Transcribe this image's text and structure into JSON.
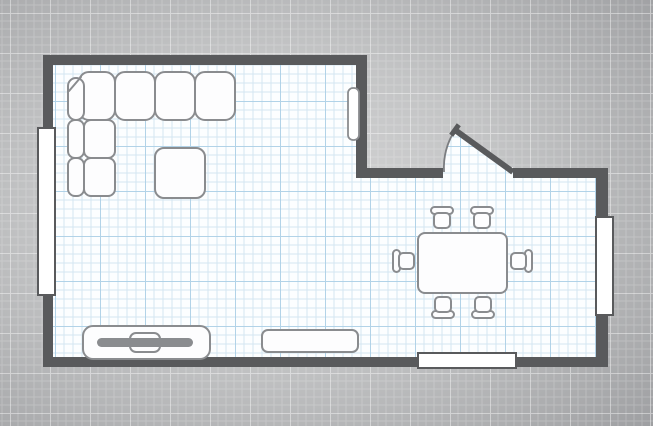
{
  "title": "floor-plan-canvas",
  "canvas": {
    "width": 653,
    "height": 426
  },
  "colors": {
    "wall": "#595a5c",
    "exterior_center": "#d5d5d6",
    "exterior_mid": "#c3c4c5",
    "exterior_edge": "#9c9da0",
    "exterior_grid": "#ffffff",
    "floor": "#fcfeff",
    "floor_grid": "#cde2f0",
    "floor_grid_accent": "#aacfe6",
    "furniture_fill": "#fdfdfe",
    "furniture_stroke": "#8a8c8f",
    "tv_screen_fill": "#8a8c8f",
    "window_fill": "#ffffff",
    "window_stroke": "#595a5c",
    "door_arc_stroke": "#7b7d80"
  },
  "grids": {
    "floor": {
      "cell": 9,
      "accent_every": 5,
      "offset": [
        10,
        11
      ]
    },
    "exterior": {
      "cell": 8,
      "accent_every": 5,
      "offset": [
        10,
        13
      ]
    }
  },
  "floor_polygon": [
    [
      53,
      65
    ],
    [
      356,
      65
    ],
    [
      356,
      178
    ],
    [
      596,
      178
    ],
    [
      596,
      357
    ],
    [
      53,
      357
    ]
  ],
  "walls": [
    {
      "name": "wall-top",
      "x": 43,
      "y": 55,
      "w": 324,
      "h": 10
    },
    {
      "name": "wall-left",
      "x": 43,
      "y": 55,
      "w": 10,
      "h": 312
    },
    {
      "name": "wall-bottom",
      "x": 43,
      "y": 357,
      "w": 565,
      "h": 10
    },
    {
      "name": "wall-inner-vertical",
      "x": 356,
      "y": 55,
      "w": 11,
      "h": 123
    },
    {
      "name": "wall-hall-left",
      "x": 356,
      "y": 168,
      "w": 87,
      "h": 10
    },
    {
      "name": "wall-hall-right",
      "x": 513,
      "y": 168,
      "w": 95,
      "h": 10
    },
    {
      "name": "wall-right",
      "x": 596,
      "y": 168,
      "w": 12,
      "h": 199
    }
  ],
  "windows": [
    {
      "name": "window-left",
      "x": 38,
      "y": 128,
      "w": 17,
      "h": 167
    },
    {
      "name": "window-right",
      "x": 596,
      "y": 217,
      "w": 17,
      "h": 98
    },
    {
      "name": "window-bottom",
      "x": 418,
      "y": 353,
      "w": 98,
      "h": 15
    }
  ],
  "door": {
    "name": "entry-door",
    "opening": {
      "x": 443,
      "y": 168,
      "w": 70,
      "h": 10
    },
    "hinge": [
      513,
      172
    ],
    "arc_start": [
      444,
      172
    ],
    "tip": [
      455,
      130
    ],
    "radius": 71,
    "leaf_width": 6,
    "cap_half_length": 6.5,
    "cap_width": 5
  },
  "radiator": {
    "name": "radiator",
    "x": 348,
    "y": 88,
    "w": 11,
    "h": 52,
    "r": 5
  },
  "furniture": {
    "sofa": {
      "name": "corner-sofa",
      "cushions": [
        {
          "x": 79,
          "y": 72,
          "w": 36,
          "h": 48,
          "r": 10
        },
        {
          "x": 115,
          "y": 72,
          "w": 40,
          "h": 48,
          "r": 10
        },
        {
          "x": 155,
          "y": 72,
          "w": 40,
          "h": 48,
          "r": 10
        },
        {
          "x": 195,
          "y": 72,
          "w": 40,
          "h": 48,
          "r": 10
        },
        {
          "x": 68,
          "y": 78,
          "w": 16,
          "h": 42,
          "r": 8
        },
        {
          "x": 68,
          "y": 120,
          "w": 16,
          "h": 38,
          "r": 7
        },
        {
          "x": 68,
          "y": 158,
          "w": 16,
          "h": 38,
          "r": 7
        },
        {
          "x": 84,
          "y": 120,
          "w": 31,
          "h": 38,
          "r": 7
        },
        {
          "x": 84,
          "y": 158,
          "w": 31,
          "h": 38,
          "r": 7
        }
      ],
      "chamfer": [
        [
          69,
          91
        ],
        [
          81,
          77
        ]
      ]
    },
    "coffee_table": {
      "name": "coffee-table",
      "x": 155,
      "y": 148,
      "w": 50,
      "h": 50,
      "r": 9
    },
    "tv_bench": {
      "name": "tv-bench",
      "x": 83,
      "y": 326,
      "w": 127,
      "h": 33,
      "r": 10
    },
    "tv_mount": {
      "name": "tv-mount",
      "x": 130,
      "y": 333,
      "w": 30,
      "h": 19,
      "r": 6
    },
    "tv_screen": {
      "name": "tv-screen",
      "x": 97,
      "y": 338,
      "w": 96,
      "h": 9,
      "r": 4.5
    },
    "sideboard": {
      "name": "sideboard",
      "x": 262,
      "y": 330,
      "w": 96,
      "h": 22,
      "r": 6
    },
    "dining_table": {
      "name": "dining-table",
      "x": 418,
      "y": 233,
      "w": 89,
      "h": 60,
      "r": 7
    },
    "chair_shape": {
      "seat": {
        "x": -8,
        "y": -13,
        "w": 16,
        "h": 15,
        "r": 4
      },
      "back": {
        "x": -11,
        "y": 1,
        "w": 22,
        "h": 7,
        "r": 3.5
      }
    },
    "dining_chairs": [
      {
        "name": "dining-chair-top-1",
        "x": 442,
        "y": 215,
        "rot": 180
      },
      {
        "name": "dining-chair-top-2",
        "x": 482,
        "y": 215,
        "rot": 180
      },
      {
        "name": "dining-chair-bottom-1",
        "x": 443,
        "y": 310,
        "rot": 0
      },
      {
        "name": "dining-chair-bottom-2",
        "x": 483,
        "y": 310,
        "rot": 0
      },
      {
        "name": "dining-chair-left",
        "x": 401,
        "y": 261,
        "rot": 90
      },
      {
        "name": "dining-chair-right",
        "x": 524,
        "y": 261,
        "rot": -90
      }
    ]
  }
}
